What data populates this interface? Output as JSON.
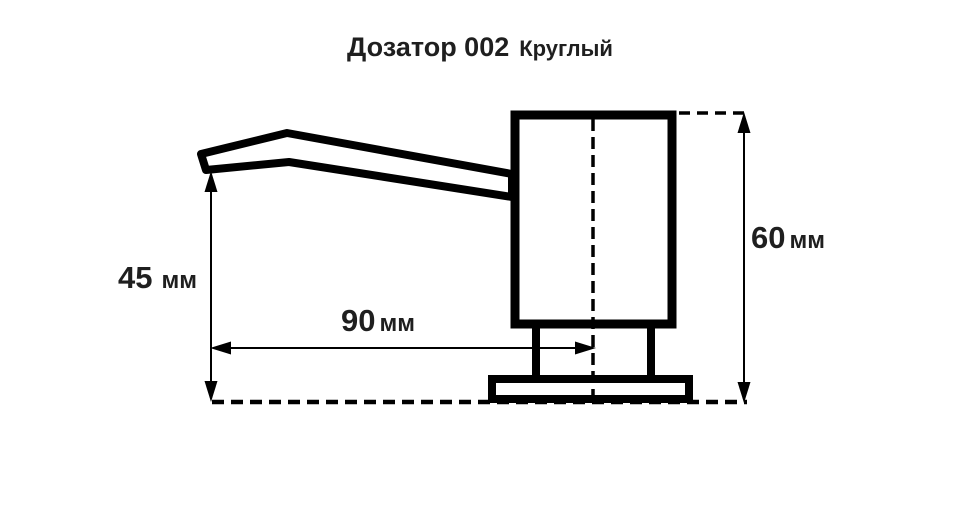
{
  "title": {
    "model": "Дозатор 002",
    "variant": "Круглый"
  },
  "dimensions": {
    "spout_height": {
      "value": "45",
      "unit": "мм"
    },
    "spout_reach": {
      "value": "90",
      "unit": "мм"
    },
    "body_height": {
      "value": "60",
      "unit": "мм"
    }
  },
  "colors": {
    "line": "#000000",
    "text": "#1f1f1f",
    "background": "#ffffff"
  }
}
